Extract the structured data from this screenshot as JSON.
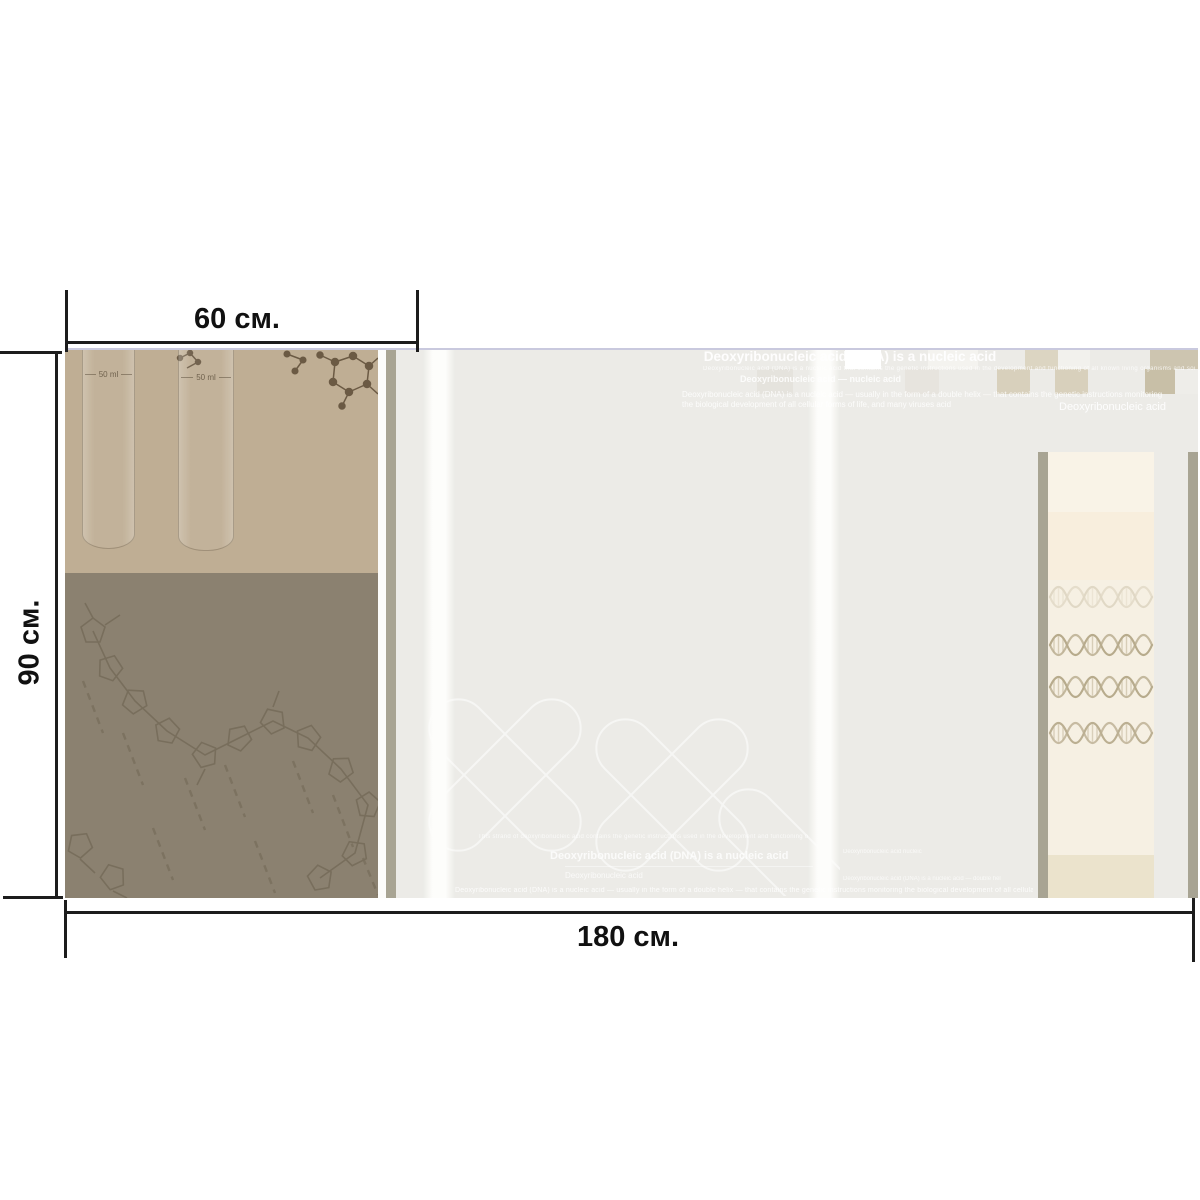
{
  "dimensions": {
    "width_label": "60 см.",
    "height_label": "90 см.",
    "total_width_label": "180 см."
  },
  "panel_left": {
    "tube1_label": "50 ml",
    "tube2_label": "50 ml"
  },
  "panel_middle": {
    "header": {
      "title": "Deoxyribonucleic acid (DNA) is a nucleic acid",
      "subline": "Deoxyribonucleic acid (DNA) is a nucleic acid that contains the genetic instructions used in the development and functioning of all known living organisms and some viruses acid",
      "subtitle": "Deoxyribonucleic acid — nucleic acid",
      "paragraph": "Deoxyribonucleic acid (DNA) is a nucleic acid — usually in the form of a double helix — that contains the genetic instructions monitoring the biological development of all cellular forms of life, and many viruses acid",
      "right_label": "Deoxyribonucleic acid"
    },
    "footer": {
      "tiny_line": "This strand of deoxyribonucleic acid contains the genetic instructions used in the development and functioning of all known living organisms",
      "headline": "Deoxyribonucleic acid (DNA) is a nucleic acid",
      "small_label": "Deoxyribonucleic acid",
      "edge_line": "Deoxyribonucleic acid (DNA) is a nucleic acid — usually in the form of a double helix — that contains the genetic instructions monitoring the biological development of all cellular forms of life acid"
    }
  },
  "panel_right": {
    "tiny_line1": "Deoxyribonucleic acid nucleic",
    "tiny_line2": "Deoxyribonucleic acid (DNA) is a nucleic acid — double helix acid"
  },
  "palette": {
    "tan": "#bfae94",
    "taupe": "#8b8170",
    "olive_stripe": "#a8a493",
    "field_gray": "#ecebe7",
    "cream": "#f6f0e3",
    "cream_dark": "#ebe3cc",
    "cream_peach": "#f8eedd",
    "lavender_line": "#bfbfd8",
    "dimension_line": "#1c1c1c",
    "helix_stroke": "#a39470"
  },
  "checkerboard": {
    "squares": [
      {
        "x": 845,
        "y": 350,
        "w": 36,
        "h": 19,
        "c": "#ffffff"
      },
      {
        "x": 928,
        "y": 350,
        "w": 50,
        "h": 19,
        "c": "#f4f3ef"
      },
      {
        "x": 1025,
        "y": 350,
        "w": 33,
        "h": 19,
        "c": "#dcd5c2"
      },
      {
        "x": 1058,
        "y": 350,
        "w": 32,
        "h": 19,
        "c": "#f2f1ed"
      },
      {
        "x": 1150,
        "y": 350,
        "w": 48,
        "h": 19,
        "c": "#cdc5b0"
      },
      {
        "x": 757,
        "y": 369,
        "w": 36,
        "h": 25,
        "c": "#e5e3dd"
      },
      {
        "x": 905,
        "y": 369,
        "w": 34,
        "h": 25,
        "c": "#e7e4de"
      },
      {
        "x": 997,
        "y": 369,
        "w": 33,
        "h": 25,
        "c": "#d8d0bc"
      },
      {
        "x": 1055,
        "y": 369,
        "w": 33,
        "h": 25,
        "c": "#d8d0bc"
      },
      {
        "x": 1145,
        "y": 369,
        "w": 30,
        "h": 25,
        "c": "#c8bfa7"
      },
      {
        "x": 1175,
        "y": 369,
        "w": 23,
        "h": 25,
        "c": "#eeede9"
      }
    ]
  }
}
